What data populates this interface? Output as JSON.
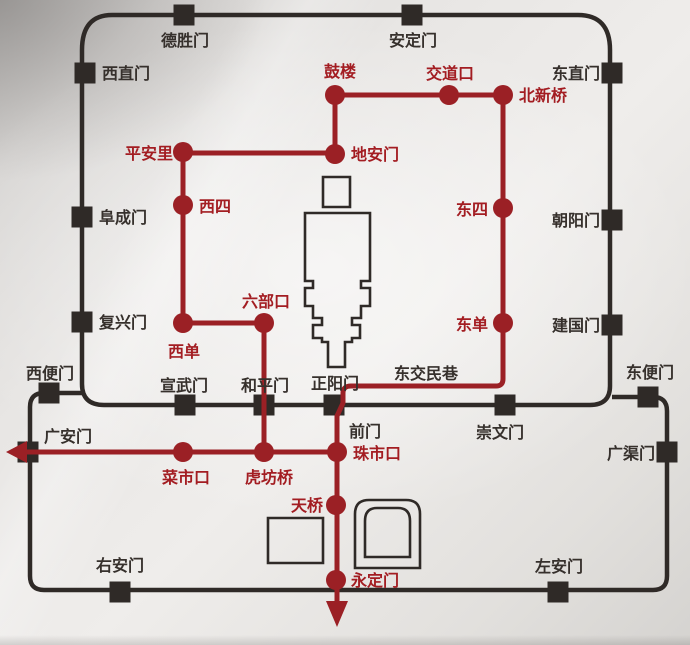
{
  "colors": {
    "route_red": "#9b2025",
    "red_label": "#a31d22",
    "wall_black": "#2f2a27",
    "black_label": "#36302c"
  },
  "map": {
    "walls": [
      {
        "id": "inner-city-wall",
        "d": "M112 15 L578 15 Q610 15 610 50 L610 386 Q610 405 590 405 L104 405 Q82 405 82 384 L82 50 Q82 15 112 15 Z"
      },
      {
        "id": "outer-city-wall",
        "d": "M82 393 L44 393 Q30 393 30 407 L30 576 Q30 590 44 590 L653 590 Q667 590 667 576 L667 411 Q667 397 653 397 L612 397"
      }
    ],
    "landmarks": [
      {
        "id": "palace-north-square",
        "d": "M323 177 L350 177 L350 207 L323 207 Z"
      },
      {
        "id": "palace-axis-outline",
        "d": "M305 213 L370 213 L370 281 L361 281 L361 288 L370 288 L370 306 L361 306 L361 318 L352 318 L352 325 L360 325 L360 338 L352 338 L352 342 L345 342 L345 367 L328 367 L328 342 L322 342 L322 338 L313 338 L313 325 L322 325 L322 318 L313 318 L313 306 L305 306 L305 288 L313 288 L313 281 L305 281 Z"
      },
      {
        "id": "altar-square-west",
        "d": "M268 518 L323 518 L323 563 L268 563 Z"
      },
      {
        "id": "temple-of-heaven-outer",
        "d": "M355 568 L355 514 Q355 500 369 500 L406 500 Q420 500 420 514 L420 568 Z"
      },
      {
        "id": "temple-of-heaven-inner",
        "d": "M365 557 L365 521 Q365 508 377 508 L398 508 Q410 508 410 521 L410 557 Z"
      }
    ],
    "routes": [
      {
        "id": "route-gulou-beixinqiao",
        "d": "M335 95 L503 95"
      },
      {
        "id": "route-gulou-dianmen",
        "d": "M335 95 L335 154"
      },
      {
        "id": "route-pinganli-dianmen",
        "d": "M183 153 L335 153"
      },
      {
        "id": "route-pinganli-xidan",
        "d": "M183 152 L183 323"
      },
      {
        "id": "route-xidan-liubukou",
        "d": "M183 323 L264 323"
      },
      {
        "id": "route-liubukou-hufangqiao",
        "d": "M264 323 L264 452"
      },
      {
        "id": "route-beixinqiao-yongdingmen",
        "d": "M503 95 L503 379 Q503 386 496 386 L351 386 Q343 386 343 393 L343 403 L337 416 L337 603"
      },
      {
        "id": "route-guanganmen-zhushikou",
        "d": "M26 452 L337 452"
      }
    ],
    "arrows": [
      {
        "id": "route-arrow-west",
        "points": "6,452 27,441 27,463"
      },
      {
        "id": "route-arrow-south",
        "points": "326,601 348,601 337,627"
      }
    ],
    "gates": [
      {
        "id": "deshengmen",
        "label": "德胜门",
        "x": 184,
        "y": 15,
        "lx": 185,
        "ly": 46,
        "anchor": "middle"
      },
      {
        "id": "andingmen",
        "label": "安定门",
        "x": 412,
        "y": 15,
        "lx": 413,
        "ly": 46,
        "anchor": "middle"
      },
      {
        "id": "xizhimen",
        "label": "西直门",
        "x": 85,
        "y": 73,
        "lx": 102,
        "ly": 79,
        "anchor": "start"
      },
      {
        "id": "dongzhimen",
        "label": "东直门",
        "x": 612,
        "y": 73,
        "lx": 600,
        "ly": 79,
        "anchor": "end"
      },
      {
        "id": "fuchengmen",
        "label": "阜成门",
        "x": 82,
        "y": 217,
        "lx": 99,
        "ly": 223,
        "anchor": "start"
      },
      {
        "id": "chaoyangmen",
        "label": "朝阳门",
        "x": 612,
        "y": 220,
        "lx": 600,
        "ly": 226,
        "anchor": "end"
      },
      {
        "id": "fuxingmen",
        "label": "复兴门",
        "x": 82,
        "y": 322,
        "lx": 99,
        "ly": 328,
        "anchor": "start"
      },
      {
        "id": "jianguomen",
        "label": "建国门",
        "x": 612,
        "y": 325,
        "lx": 600,
        "ly": 331,
        "anchor": "end"
      },
      {
        "id": "xuanwumen",
        "label": "宣武门",
        "x": 185,
        "y": 405,
        "lx": 184,
        "ly": 391,
        "anchor": "middle"
      },
      {
        "id": "hepingmen",
        "label": "和平门",
        "x": 264,
        "y": 405,
        "lx": 265,
        "ly": 391,
        "anchor": "middle"
      },
      {
        "id": "zhengyangmen",
        "label": "正阳门",
        "x": 334,
        "y": 405,
        "lx": 335,
        "ly": 389,
        "anchor": "middle"
      },
      {
        "id": "chongwenmen",
        "label": "崇文门",
        "x": 505,
        "y": 405,
        "lx": 500,
        "ly": 438,
        "anchor": "middle"
      },
      {
        "id": "xibianmen",
        "label": "西便门",
        "x": 49,
        "y": 393,
        "lx": 50,
        "ly": 379,
        "anchor": "middle"
      },
      {
        "id": "dongbianmen",
        "label": "东便门",
        "x": 648,
        "y": 397,
        "lx": 650,
        "ly": 378,
        "anchor": "middle"
      },
      {
        "id": "guanganmen",
        "label": "广安门",
        "x": 28,
        "y": 452,
        "lx": 44,
        "ly": 442,
        "anchor": "start"
      },
      {
        "id": "guangqumen",
        "label": "广渠门",
        "x": 667,
        "y": 452,
        "lx": 655,
        "ly": 459,
        "anchor": "end"
      },
      {
        "id": "youanmen",
        "label": "右安门",
        "x": 120,
        "y": 592,
        "lx": 120,
        "ly": 571,
        "anchor": "middle"
      },
      {
        "id": "zuoanmen",
        "label": "左安门",
        "x": 558,
        "y": 592,
        "lx": 559,
        "ly": 572,
        "anchor": "middle"
      }
    ],
    "stations": [
      {
        "id": "gulou",
        "label": "鼓楼",
        "x": 335,
        "y": 95,
        "lx": 340,
        "ly": 77,
        "anchor": "middle"
      },
      {
        "id": "jiaodaokou",
        "label": "交道口",
        "x": 449,
        "y": 95,
        "lx": 450,
        "ly": 79,
        "anchor": "middle"
      },
      {
        "id": "beixinqiao",
        "label": "北新桥",
        "x": 503,
        "y": 95,
        "lx": 519,
        "ly": 101,
        "anchor": "start"
      },
      {
        "id": "dianmen",
        "label": "地安门",
        "x": 335,
        "y": 154,
        "lx": 351,
        "ly": 160,
        "anchor": "start"
      },
      {
        "id": "pinganli",
        "label": "平安里",
        "x": 183,
        "y": 152,
        "lx": 173,
        "ly": 159,
        "anchor": "end"
      },
      {
        "id": "xisi",
        "label": "西四",
        "x": 183,
        "y": 205,
        "lx": 199,
        "ly": 212,
        "anchor": "start"
      },
      {
        "id": "dongsi",
        "label": "东四",
        "x": 503,
        "y": 208,
        "lx": 488,
        "ly": 215,
        "anchor": "end"
      },
      {
        "id": "dongdan",
        "label": "东单",
        "x": 503,
        "y": 323,
        "lx": 488,
        "ly": 330,
        "anchor": "end"
      },
      {
        "id": "xidan",
        "label": "西单",
        "x": 183,
        "y": 323,
        "lx": 184,
        "ly": 357,
        "anchor": "middle"
      },
      {
        "id": "liubukou",
        "label": "六部口",
        "x": 264,
        "y": 323,
        "lx": 266,
        "ly": 307,
        "anchor": "middle"
      },
      {
        "id": "caishikou",
        "label": "菜市口",
        "x": 183,
        "y": 452,
        "lx": 186,
        "ly": 483,
        "anchor": "middle"
      },
      {
        "id": "hufangqiao",
        "label": "虎坊桥",
        "x": 264,
        "y": 452,
        "lx": 269,
        "ly": 483,
        "anchor": "middle"
      },
      {
        "id": "zhushikou",
        "label": "珠市口",
        "x": 337,
        "y": 452,
        "lx": 353,
        "ly": 459,
        "anchor": "start"
      },
      {
        "id": "tianqiao",
        "label": "天桥",
        "x": 336,
        "y": 505,
        "lx": 323,
        "ly": 511,
        "anchor": "end"
      },
      {
        "id": "yongdingmen",
        "label": "永定门",
        "x": 336,
        "y": 580,
        "lx": 351,
        "ly": 586,
        "anchor": "start"
      }
    ],
    "street_labels": [
      {
        "id": "dongjiaominxiang",
        "label": "东交民巷",
        "lx": 426,
        "ly": 379,
        "anchor": "middle"
      },
      {
        "id": "qianmen",
        "label": "前门",
        "lx": 349,
        "ly": 437,
        "anchor": "start"
      }
    ]
  }
}
